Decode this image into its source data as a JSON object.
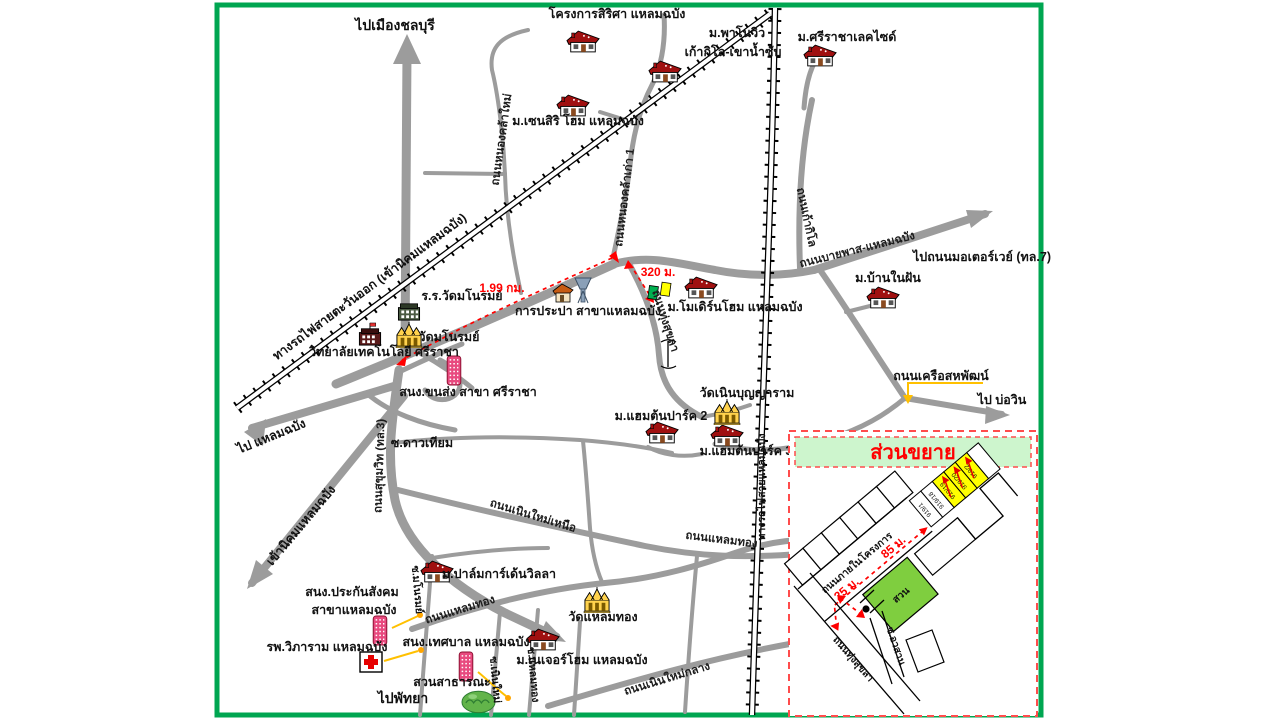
{
  "colors": {
    "border_green": "#00A651",
    "road_gray": "#9C9C9C",
    "route_red": "#FF0000",
    "connector_yellow": "#FFC000",
    "inset_header_bg": "#CDF5CD",
    "garden_green": "#7FCE3F",
    "plot_yellow": "#FFFF00",
    "house_roof": "#A01010",
    "office_pink": "#E84A7F"
  },
  "destinations": {
    "chonburi": "ไปเมืองชลบุรี",
    "laem_chabang": "ไป แหลมฉบัง",
    "nikhom": "เข้านิคมแหลมฉบัง",
    "pattaya": "ไปพัทยา",
    "motorway": "ไปถนนมอเตอร์เวย์ (ทล.7)",
    "bowin": "ไป บ่อวิน"
  },
  "roads": {
    "sukhumvit": "ถนนสุขุมวิท (ทล.3)",
    "thung_sukhla": "ถนนทุ่งสุขลา",
    "bypass": "ถนนบายพาส-แหลมฉบัง",
    "kao_kilo": "ถนนเก้ากิโล",
    "nong_khla_kao": "ถนนหนองคล้าเก่า 1",
    "nong_khla_mai": "ถนนหนองคล้าใหม่",
    "khruea_sahaphat": "ถนนเครือสหพัฒน์",
    "noen_mai_nuea": "ถนนเนินใหม่เหนือ",
    "noen_mai_klang": "ถนนเนินใหม่กลาง",
    "laem_thong": "ถนนแหลมทอง",
    "soi_dao_thiam": "ซ.ดาวเทียม",
    "soi_manorom": "ซ.มโนรมย์",
    "soi_noen_mai": "ซ.เนินใหม่",
    "soi_laem_thong": "ซ.แหลมทอง"
  },
  "railways": {
    "eastern": "ทางรถไฟสายตะวันออก (เข้านิคมแหลมฉบัง)",
    "laem_chabang": "ทางรถไฟสายแหลมฉบัง"
  },
  "places": {
    "sirisa": "โครงการสิริศา แหลมฉบัง",
    "panoview1": "ม.พาโนวิว",
    "panoview2": "เก้ากิโล-เขาน้ำซับ",
    "lakeside": "ม.ศรีราชาเลคไซด์",
    "zensiri": "ม.เซนสิริ โฮม แหลมฉบัง",
    "school_manorom": "ร.ร.วัดมโนรมย์",
    "wat_manorom": "วัดมโนรมย์",
    "college": "วิทยาลัยเทคโนโลยี ศรีราชา",
    "waterworks": "การประปา สาขาแหลมฉบัง",
    "modern_home": "ม.โมเดิร์นโฮม แหลมฉบัง",
    "ban_nai_fun": "ม.บ้านในฝัน",
    "transport": "สนง.ขนส่ง สาขา ศรีราชา",
    "wat_noen": "วัดเนินบุญญาราม",
    "hampton2": "ม.แฮมต้นปาร์ค 2",
    "hampton3": "ม.แฮมต้นปาร์ค 3",
    "palm_garden": "ม.ปาล์มการ์เด้นวิลลา",
    "sso1": "สนง.ประกันสังคม",
    "sso2": "สาขาแหลมฉบัง",
    "hospital": "รพ.วิภาราม แหลมฉบัง",
    "municipality": "สนง.เทศบาล แหลมฉบัง",
    "park": "สวนสาธารณะ",
    "wat_laem_thong": "วัดแหลมทอง",
    "nature_home": "ม.เนเจอร์โฮม แหลมฉบัง"
  },
  "distances": {
    "route": "1.99 กม.",
    "to_site": "320 ม."
  },
  "inset": {
    "title": "ส่วนขยาย",
    "internal_road": "ถนนภายในโครงการ",
    "dist_main": "85 ม.",
    "dist_entry": "25 ม.",
    "garden": "สวน",
    "road": "ถนนทุ่งสุขลา",
    "soi": "ซ.อวสาน",
    "plots": [
      "919/1",
      "919/18",
      "919/19",
      "919/20",
      "919/2"
    ]
  }
}
